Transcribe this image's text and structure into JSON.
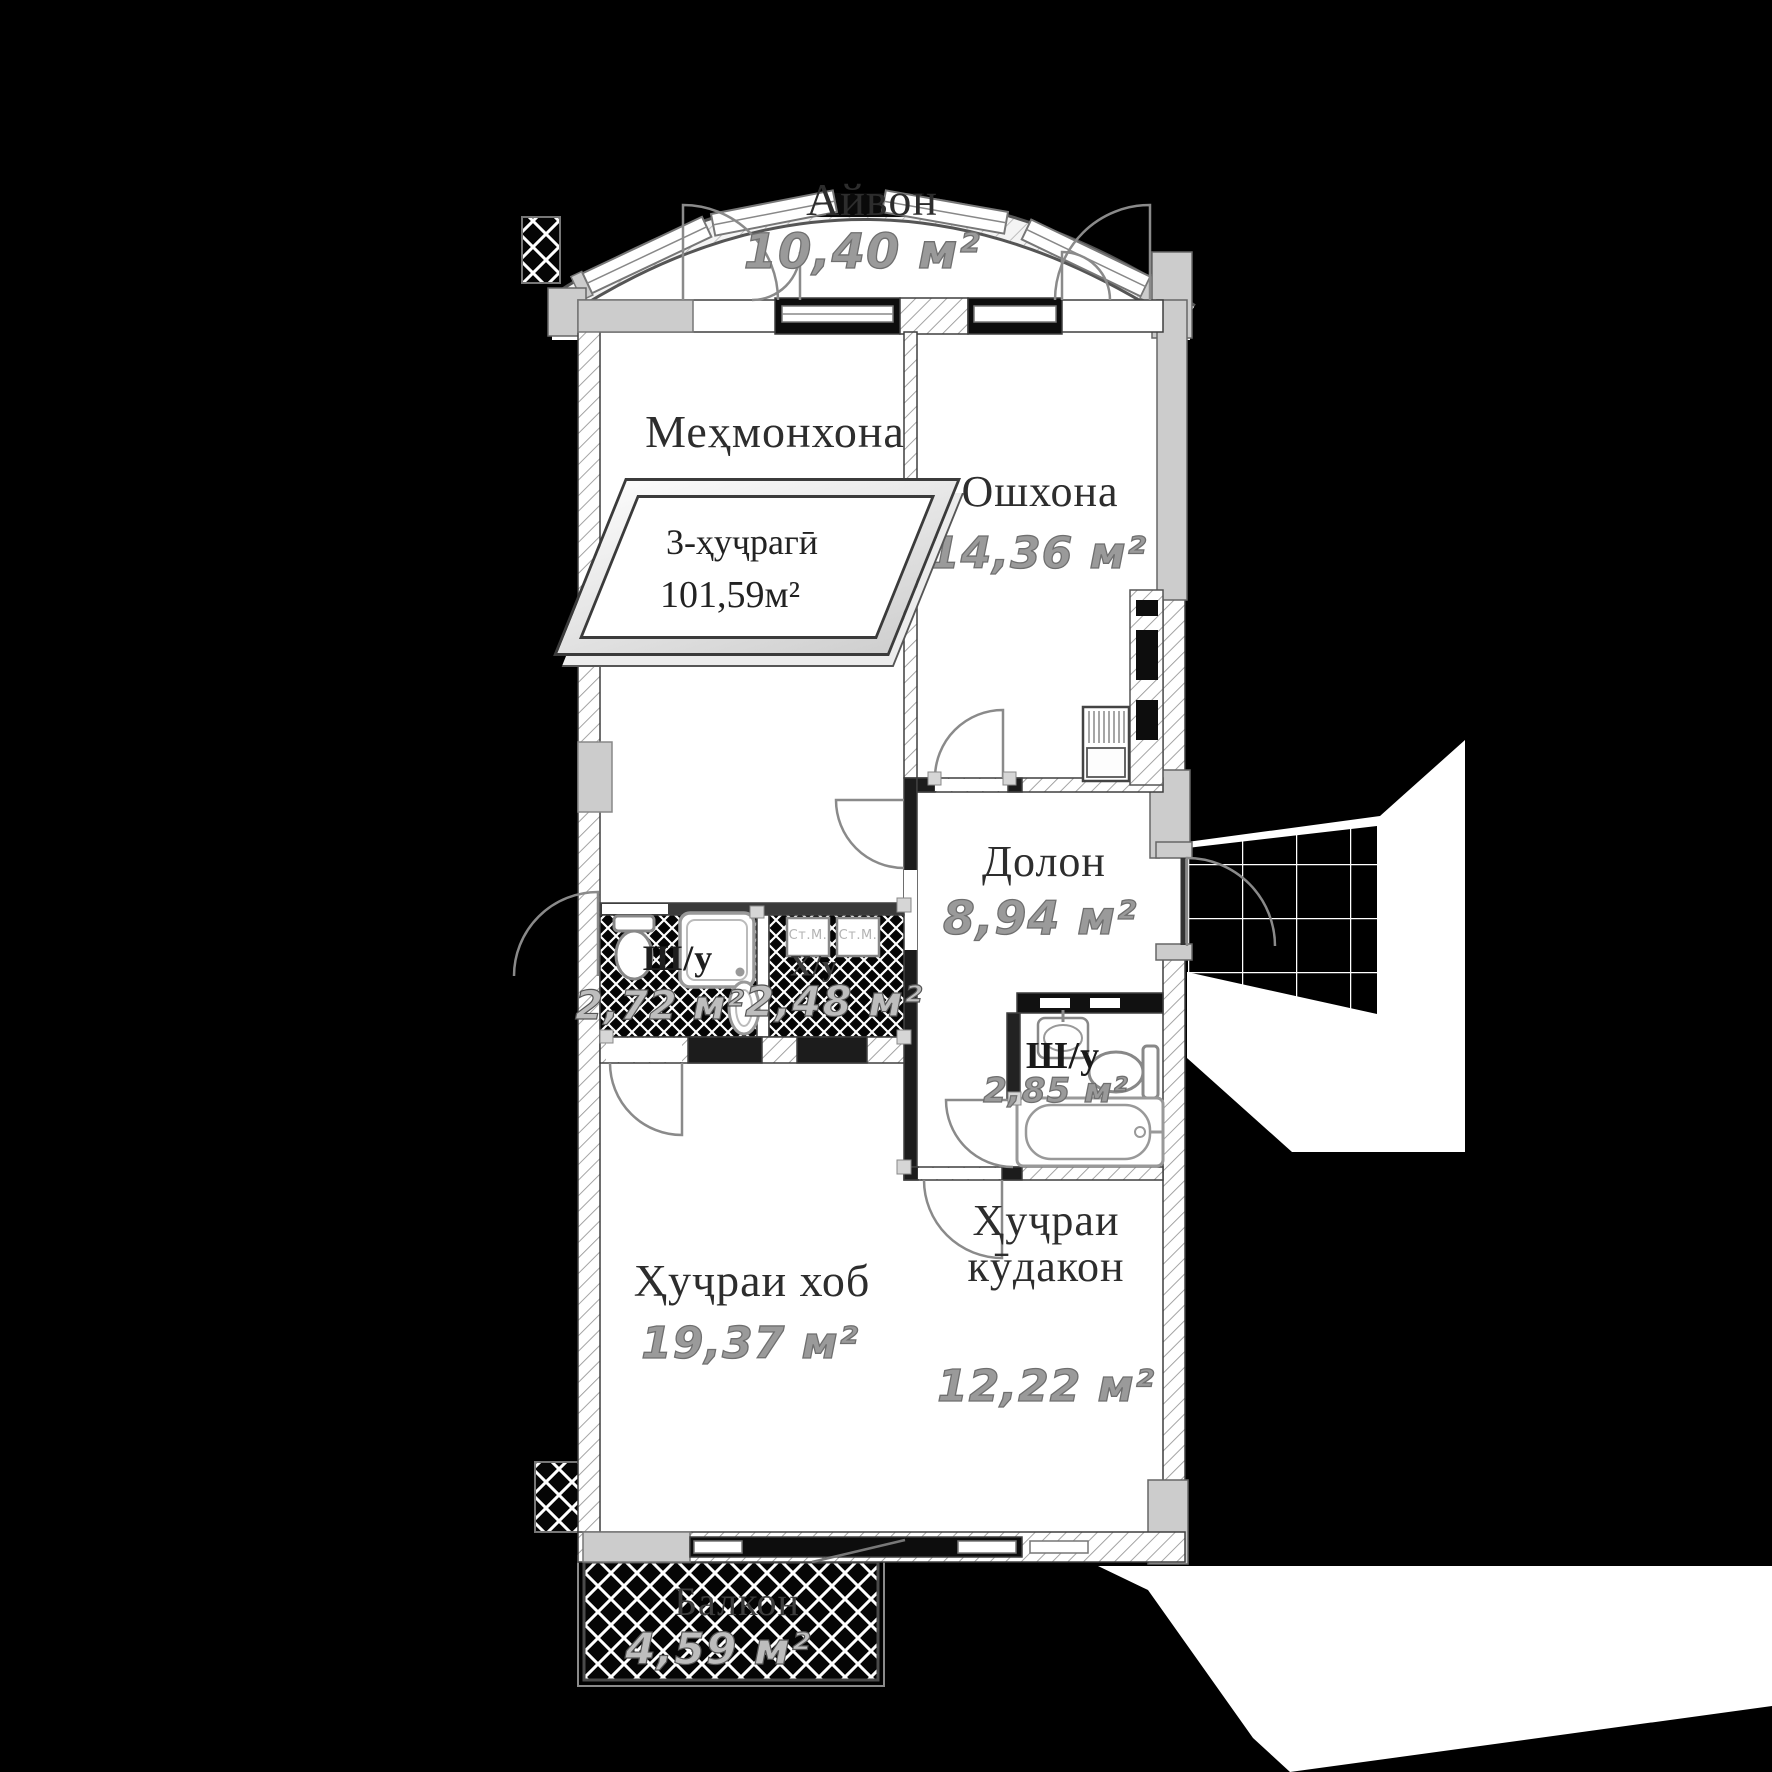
{
  "plan": {
    "stamp": {
      "type_label": "3-ҳуҷрагӣ",
      "total_area": "101,59м²"
    },
    "rooms": {
      "veranda": {
        "name": "Айвон",
        "area": "10,40 м²"
      },
      "living": {
        "name": "Меҳмонхона",
        "area": "23,66 м²"
      },
      "kitchen": {
        "name": "Ошхона",
        "area": "14,36 м²"
      },
      "hall": {
        "name": "Долон",
        "area": "8,94 м²"
      },
      "bath_left": {
        "name": "Ш/у",
        "area": "2,72 м²"
      },
      "laundry": {
        "name": "Х/у",
        "area": "2,48 м²"
      },
      "bath_right": {
        "name": "Ш/у",
        "area": "2,85 м²"
      },
      "bedroom": {
        "name": "Ҳуҷраи хоб",
        "area": "19,37 м²"
      },
      "kids": {
        "name_line1": "Ҳуҷраи",
        "name_line2": "кӯдакон",
        "area": "12,22 м²"
      },
      "balcony": {
        "name": "Балкон",
        "area": "4,59 м²"
      }
    },
    "appliances": {
      "washer_left": "Ст.М.",
      "washer_right": "Ст.М."
    },
    "colors": {
      "background": "#000000",
      "floor": "#ffffff",
      "wall_gray": "#cccccc",
      "line_dark": "#3f3f3f",
      "area_text": "#9a9a9a",
      "room_text": "#2d2d2d"
    }
  }
}
